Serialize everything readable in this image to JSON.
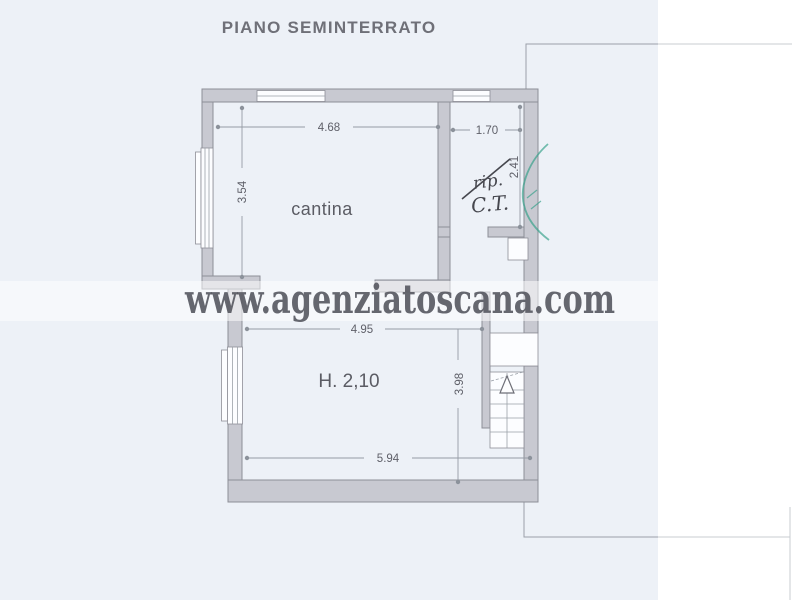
{
  "document": {
    "title": "PIANO SEMINTERRATO",
    "watermark": "www.agenziatoscana.com"
  },
  "plan": {
    "labels": {
      "cantina": "cantina",
      "rip_struck": "rip.",
      "ct": "C.T.",
      "height_note": "H. 2,10"
    },
    "dimensions": {
      "cantina_width": "4.68",
      "cantina_depth": "3.54",
      "ct_width": "1.70",
      "ct_depth": "2.41",
      "lower_room_width": "4.95",
      "lower_room_depth": "3.98",
      "lower_room_width_bottom": "5.94"
    }
  },
  "colors": {
    "paper": "#edf1f7",
    "wall_fill": "#c8c9d1",
    "wall_stroke": "#8d8e97",
    "ink": "#5f6069",
    "watermark": "#55565f",
    "stamp_green": "#2e9e86"
  }
}
